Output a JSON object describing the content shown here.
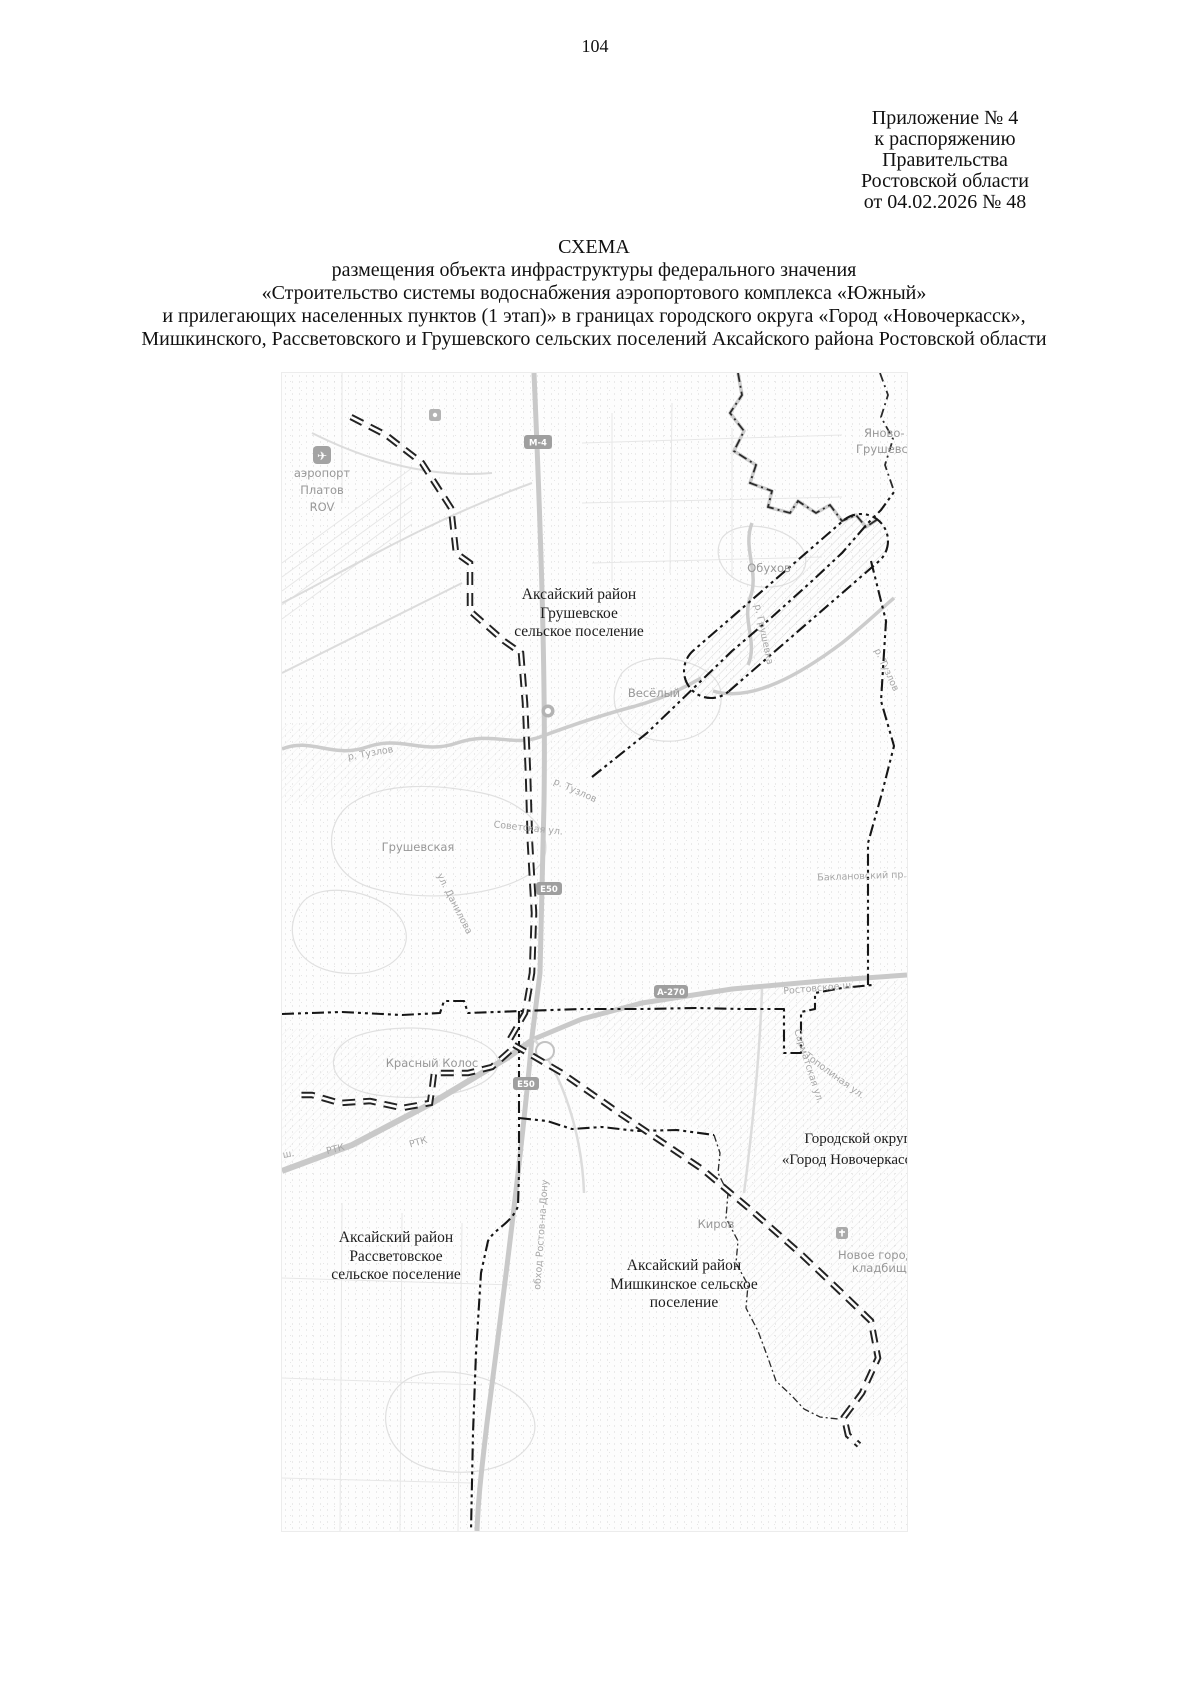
{
  "page": {
    "number": "104"
  },
  "header": {
    "line1": "Приложение № 4",
    "line2": "к распоряжению",
    "line3": "Правительства",
    "line4": "Ростовской области",
    "line5": "от 04.02.2026 № 48"
  },
  "title": {
    "line1": "СХЕМА",
    "line2": "размещения объекта инфраструктуры федерального значения",
    "line3": "«Строительство системы водоснабжения аэропортового комплекса «Южный»",
    "line4": "и прилегающих населенных пунктов (1 этап)» в границах городского округа «Город «Новочеркасск»,",
    "line5": "Мишкинского, Рассветовского и Грушевского сельских поселений Аксайского района Ростовской области"
  },
  "map": {
    "areas": {
      "grushevskoe": {
        "l1": "Аксайский район",
        "l2": "Грушевское",
        "l3": "сельское поселение"
      },
      "novocherkassk": {
        "l1": "Городской округ",
        "l2": "«Город Новочеркасск»"
      },
      "rassvetovskoe": {
        "l1": "Аксайский район",
        "l2": "Рассветовское",
        "l3": "сельское поселение"
      },
      "mishkinskoe": {
        "l1": "Аксайский район",
        "l2": "Мишкинское сельское",
        "l3": "поселение"
      }
    },
    "settlements": {
      "yanovo1": "Яново-",
      "yanovo2": "Грушевский",
      "obukhov": "Обухов",
      "vesyoly": "Весёлый",
      "grushevskaya": "Грушевская",
      "krasny_kolos": "Красный Колос",
      "kirov": "Киров",
      "airport1": "аэропорт",
      "airport2": "Платов",
      "airport3": "ROV",
      "cemetery1": "Новое городское",
      "cemetery2": "кладбище"
    },
    "streets": {
      "tuzlov": "р. Тузлов",
      "grushevka": "р. Грушевка",
      "sovetskaya": "Советская ул.",
      "danilova": "ул. Данилова",
      "rostovskoe": "Ростовское ш.",
      "baklanovsky": "Баклановский пр.",
      "rtk": "РТК",
      "sh": "ш.",
      "obkhod": "обход Ростов-на-Дону",
      "topolinaya": "Тополиная ул.",
      "sarmatskaya": "Сарматская ул."
    },
    "badges": {
      "m4": "М-4",
      "e50": "Е50",
      "a270": "А-270"
    },
    "colors": {
      "boundary": "#161616",
      "route": "#222222",
      "road": "#c9c9c9",
      "gray_label": "#979797"
    }
  }
}
